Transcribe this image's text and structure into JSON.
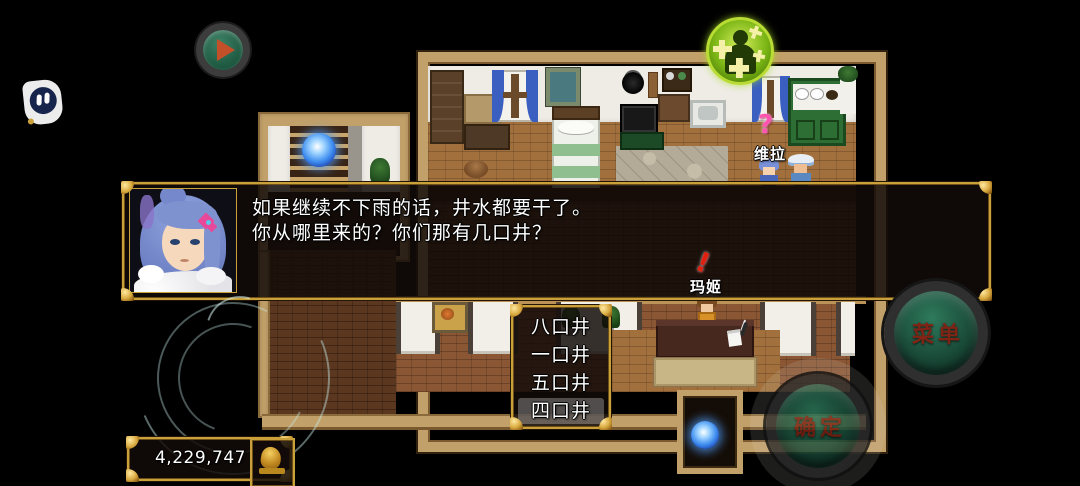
{
  "hud": {
    "gold": {
      "amount": "4,229,747"
    },
    "buttons": {
      "menu": "菜单",
      "confirm": "确定"
    },
    "icons": {
      "assistive": "floating-assistive-touch",
      "play": "play-button",
      "buff": "level-up-buff"
    }
  },
  "dialog": {
    "portrait": "blue-haired-girl",
    "lines": {
      "l1": "如果继续不下雨的话，井水都要干了。",
      "l2": "你从哪里来的？你们那有几口井？"
    }
  },
  "choice_menu": {
    "options": [
      "八口井",
      "一口井",
      "五口井",
      "四口井"
    ],
    "selected_index": 3
  },
  "npcs": {
    "vera": {
      "name": "维拉",
      "balloon": "?"
    },
    "maggie": {
      "name": "玛姬",
      "balloon": "!"
    }
  },
  "colors": {
    "gold_border": "#c9a03a",
    "button_text_red": "#802415",
    "button_green": "#1d5c44",
    "orb_blue": "#3f8ef0"
  }
}
